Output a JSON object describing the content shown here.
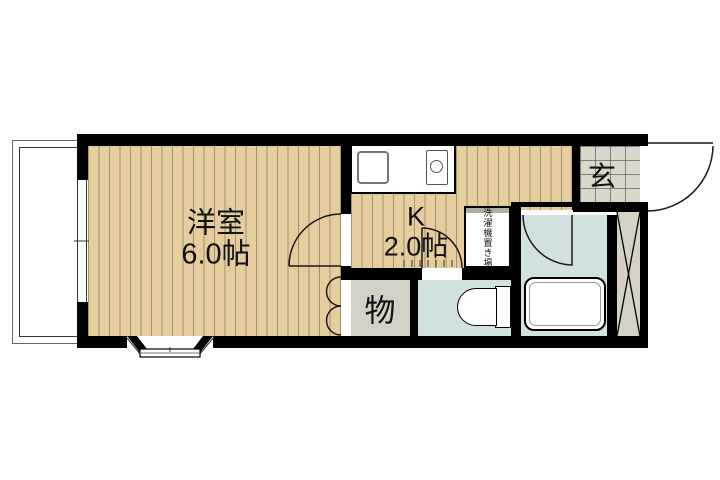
{
  "plan": {
    "rooms": {
      "western_room": {
        "name": "洋室",
        "size": "6.0帖"
      },
      "kitchen": {
        "name": "K",
        "size": "2.0帖"
      },
      "entrance": {
        "name": "玄"
      },
      "storage": {
        "name": "物"
      },
      "laundry_space": {
        "name": "洗濯機置き場"
      }
    },
    "colors": {
      "wall": "#000000",
      "wood_floor": "#e6cd9d",
      "floor_stripe": "#9d9478",
      "entrance_tile": "#d9d6ca",
      "storage_floor": "#d3d0c6",
      "wet_area_floor": "#cfe2e0",
      "duct_space": "#d5d2c4",
      "background": "#ffffff"
    },
    "fixtures": {
      "kitchen_counter": "kitchen-counter",
      "sink": "sink-icon",
      "stove": "stove-burner-icon",
      "toilet": "toilet-icon",
      "bathtub": "bathtub-icon",
      "balcony": "balcony",
      "bay_window": "bay-window",
      "duct": "duct-space"
    }
  }
}
